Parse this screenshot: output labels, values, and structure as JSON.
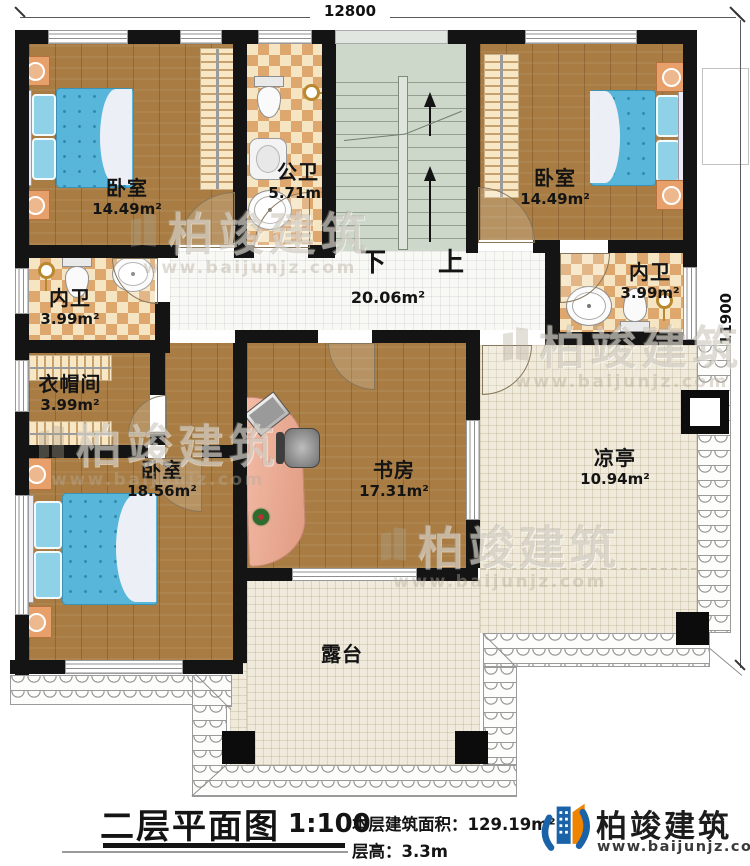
{
  "dimensions": {
    "top": "12800",
    "right": "11900"
  },
  "stairs": {
    "down": "下",
    "up": "上"
  },
  "rooms": {
    "bedroom_tl": {
      "name": "卧室",
      "area": "14.49m²"
    },
    "public_bath": {
      "name": "公卫",
      "area": "5.71m²"
    },
    "bedroom_tr": {
      "name": "卧室",
      "area": "14.49m²"
    },
    "bath_right": {
      "name": "内卫",
      "area": "3.99m²"
    },
    "bath_left": {
      "name": "内卫",
      "area": "3.99m²"
    },
    "cloakroom": {
      "name": "衣帽间",
      "area": "3.99m²"
    },
    "bedroom_bl": {
      "name": "卧室",
      "area": "18.56m²"
    },
    "study": {
      "name": "书房",
      "area": "17.31m²"
    },
    "pavilion": {
      "name": "凉亭",
      "area": "10.94m²"
    },
    "hallway": {
      "area": "20.06m²"
    },
    "terrace": {
      "name": "露台"
    }
  },
  "title_block": {
    "title": "二层平面图",
    "scale": "1:100",
    "area_label": "本层建筑面积：",
    "area_value": "129.19m²",
    "height_label": "层高：",
    "height_value": "3.3m"
  },
  "brand": {
    "name": "柏竣建筑",
    "url": "www.baijunjz.com"
  },
  "watermark": {
    "name": "柏竣建筑",
    "url": "www.baijunjz.com"
  },
  "colors": {
    "wall": "#141414",
    "wood": "#a87c42",
    "tile_light": "#f5e5c2",
    "tile_dark": "#dda76e",
    "stair": "#cdd8ca",
    "terrace": "#efeadb",
    "bed": "#58b6da",
    "brand_blue": "#1b63a8",
    "brand_orange": "#f08300"
  }
}
